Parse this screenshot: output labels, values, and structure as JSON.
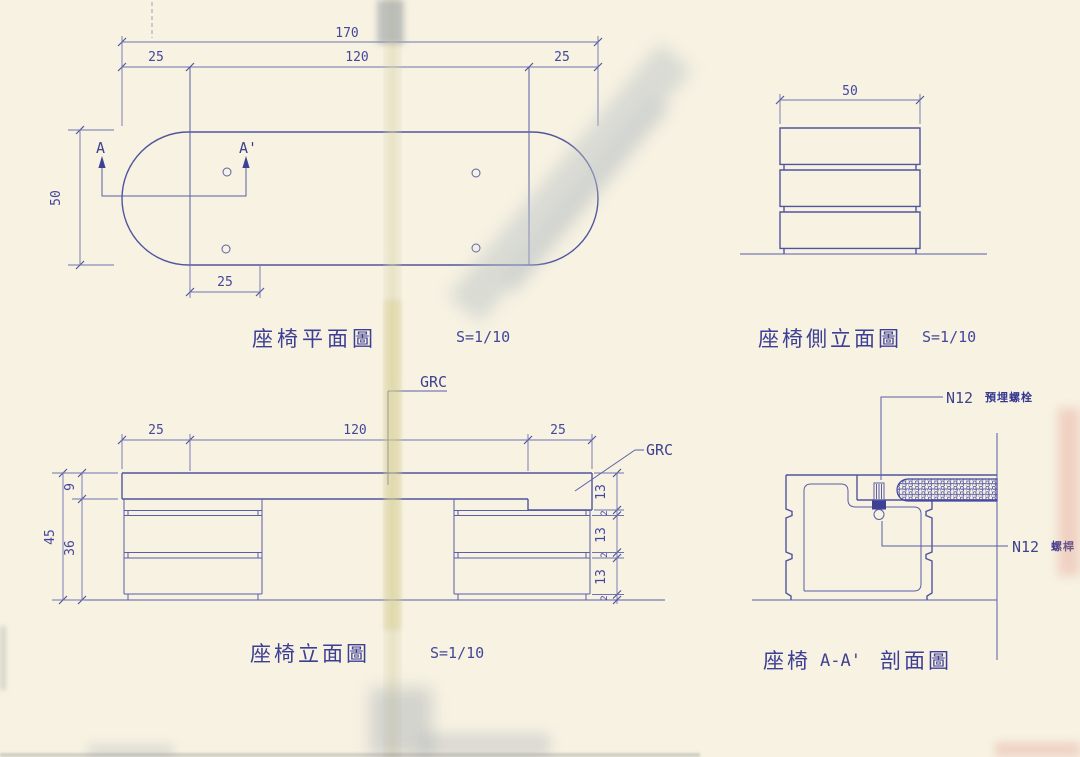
{
  "plan": {
    "title": "座椅平面圖",
    "scale": "S=1/10",
    "dim_total": "170",
    "dim_left_end": "25",
    "dim_middle": "120",
    "dim_right_end": "25",
    "dim_depth": "50",
    "dim_pedestal": "25",
    "section_start": "A",
    "section_end": "A'"
  },
  "side_elevation": {
    "title": "座椅側立面圖",
    "scale": "S=1/10",
    "dim_width": "50"
  },
  "front_elevation": {
    "title": "座椅立面圖",
    "scale": "S=1/10",
    "dim_left_end": "25",
    "dim_middle": "120",
    "dim_right_end": "25",
    "dim_total_height": "45",
    "dim_seat": "9",
    "dim_base": "36",
    "dim_block_1": "13",
    "dim_block_2": "13",
    "dim_block_3": "13",
    "dim_joint_1": "2",
    "dim_joint_2": "2",
    "dim_joint_3": "2",
    "material_top": "GRC",
    "material_right": "GRC"
  },
  "section": {
    "title_prefix": "座椅",
    "title_cut": "A-A'",
    "title_suffix": "剖面圖",
    "bolt_code": "N12",
    "bolt_name": "預埋螺栓",
    "rod_code": "N12",
    "rod_name": "螺桿"
  }
}
